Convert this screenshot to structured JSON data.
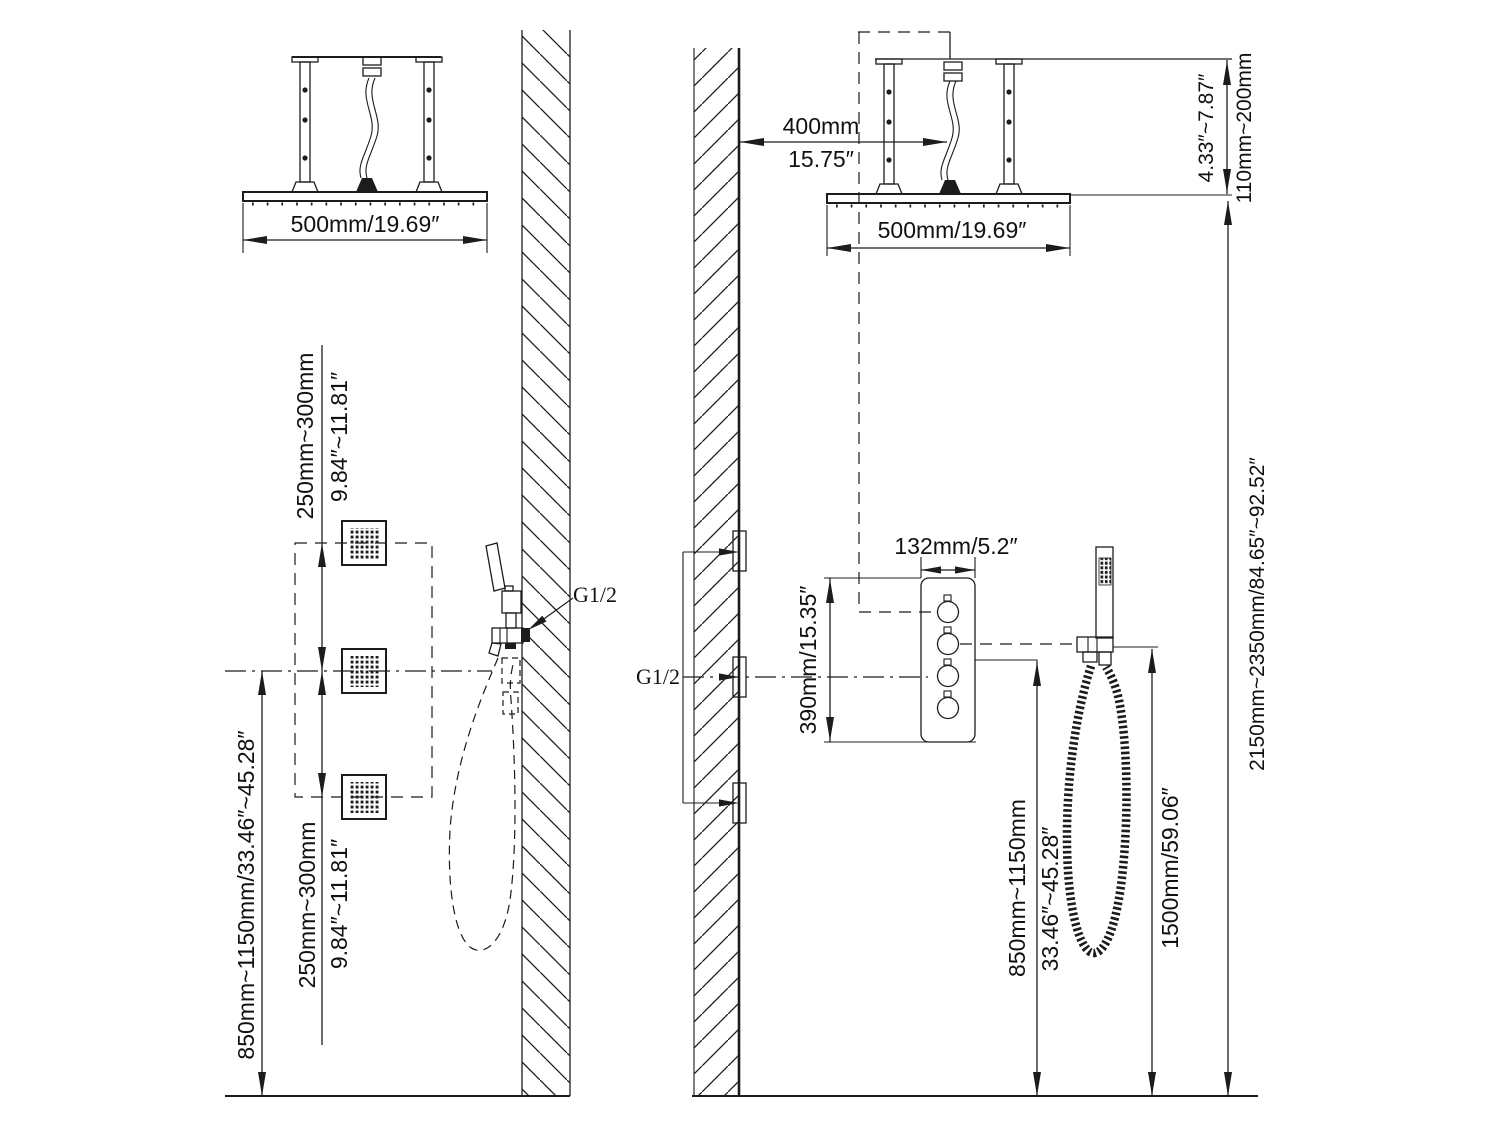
{
  "diagram": {
    "type": "shower system installation drawing",
    "line_color": "#1c1c1c",
    "background": "#ffffff"
  },
  "left_view": {
    "head_width": "500mm/19.69″",
    "jet_gap_top_mm": "250mm~300mm",
    "jet_gap_top_in": "9.84″~11.81″",
    "jet_gap_bottom_mm": "250mm~300mm",
    "jet_gap_bottom_in": "9.84″~11.81″",
    "spout_height": "850mm~1150mm/33.46″~45.28″",
    "thread_label": "G1/2"
  },
  "right_view": {
    "head_width": "500mm/19.69″",
    "wall_offset_mm": "400mm",
    "wall_offset_in": "15.75″",
    "ceiling_drop_in": "4.33″~7.87″",
    "ceiling_drop_mm": "110mm~200mm",
    "valve_width": "132mm/5.2″",
    "valve_spread": "390mm/15.35″",
    "thread_label": "G1/2",
    "valve_height_mm": "850mm~1150mm",
    "valve_height_in": "33.46″~45.28″",
    "hose_length": "1500mm/59.06″",
    "head_height": "2150mm~2350mm/84.65″~92.52″"
  }
}
